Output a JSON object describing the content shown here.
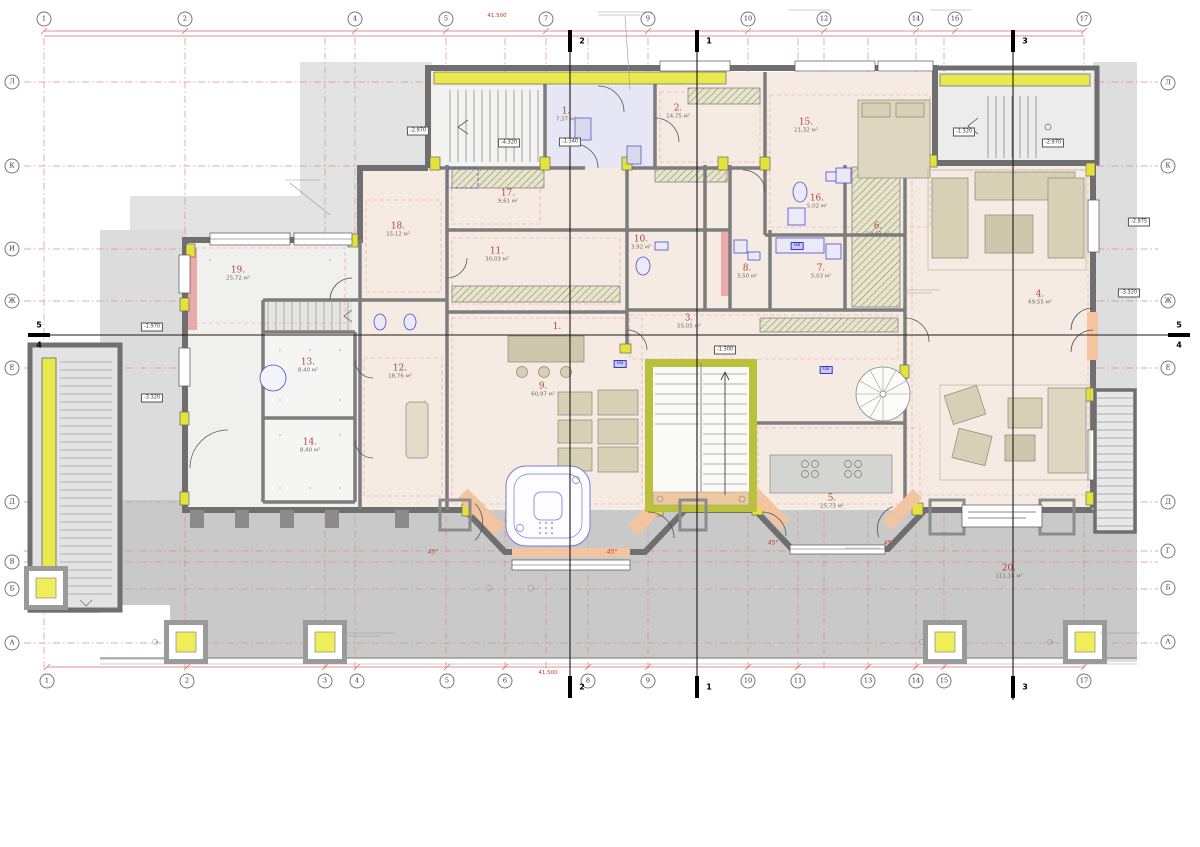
{
  "rooms": [
    {
      "number": "1.",
      "area": "7,37 м²"
    },
    {
      "number": "2.",
      "area": "14,75 м²"
    },
    {
      "number": "3.",
      "area": "55,05 м²"
    },
    {
      "number": "4.",
      "area": "69,55 м²"
    },
    {
      "number": "5.",
      "area": "25,73 м²"
    },
    {
      "number": "6.",
      "area": "10,63 м²"
    },
    {
      "number": "7.",
      "area": "5,03 м²"
    },
    {
      "number": "8.",
      "area": "3,50 м²"
    },
    {
      "number": "9.",
      "area": "60,97 м²"
    },
    {
      "number": "10.",
      "area": "3,92 м²"
    },
    {
      "number": "11.",
      "area": "30,03 м²"
    },
    {
      "number": "12.",
      "area": "18,76 м²"
    },
    {
      "number": "13.",
      "area": "8,40 м²"
    },
    {
      "number": "14.",
      "area": "8,40 м²"
    },
    {
      "number": "15.",
      "area": "21,32 м²"
    },
    {
      "number": "16.",
      "area": "5,02 м²"
    },
    {
      "number": "17.",
      "area": "9,61 м²"
    },
    {
      "number": "18.",
      "area": "15,12 м²"
    },
    {
      "number": "19.",
      "area": "25,72 м²"
    },
    {
      "number": "20.",
      "area": "111,18 м²"
    }
  ],
  "hall_label": "1.",
  "grid": {
    "top": [
      "1",
      "2",
      "4",
      "5",
      "7",
      "9",
      "10",
      "12",
      "14",
      "16",
      "17"
    ],
    "bottom": [
      "1",
      "2",
      "3",
      "4",
      "5",
      "6",
      "8",
      "9",
      "10",
      "11",
      "13",
      "14",
      "15",
      "17"
    ],
    "left": [
      "Л",
      "К",
      "И",
      "Ж",
      "Е",
      "Д",
      "В",
      "Б",
      "А"
    ],
    "right": [
      "Л",
      "К",
      "Ж",
      "Е",
      "Д",
      "Г",
      "Б",
      "А"
    ]
  },
  "sections": {
    "s1": "1",
    "s2": "2",
    "s3": "3",
    "s4": "4",
    "s5": "5"
  },
  "elevations": [
    "-2.970",
    "-4.320",
    "-1.340",
    "-1.320",
    "-2.970",
    "-1.300",
    "-3.320",
    "-1.970",
    "-3.320",
    "-2.975"
  ],
  "annotations": {
    "angle": "45°",
    "vent": "ОВ",
    "dim_total": "41.500"
  },
  "colors": {
    "wall": "#6f6f6f",
    "accent_yellow": "#e9e94f",
    "floor_pink": "#f6ebe2",
    "floor_lilac": "#e6e6f4",
    "terrace": "#c9c9c9",
    "upper_terrace": "#e3e3e3",
    "stair_core": "#b9c23a",
    "label_red": "#b5413c",
    "grid_red": "#e08a8a",
    "fixture_blue": "#4a4ad0",
    "apron_peach": "#f2c4a0"
  }
}
